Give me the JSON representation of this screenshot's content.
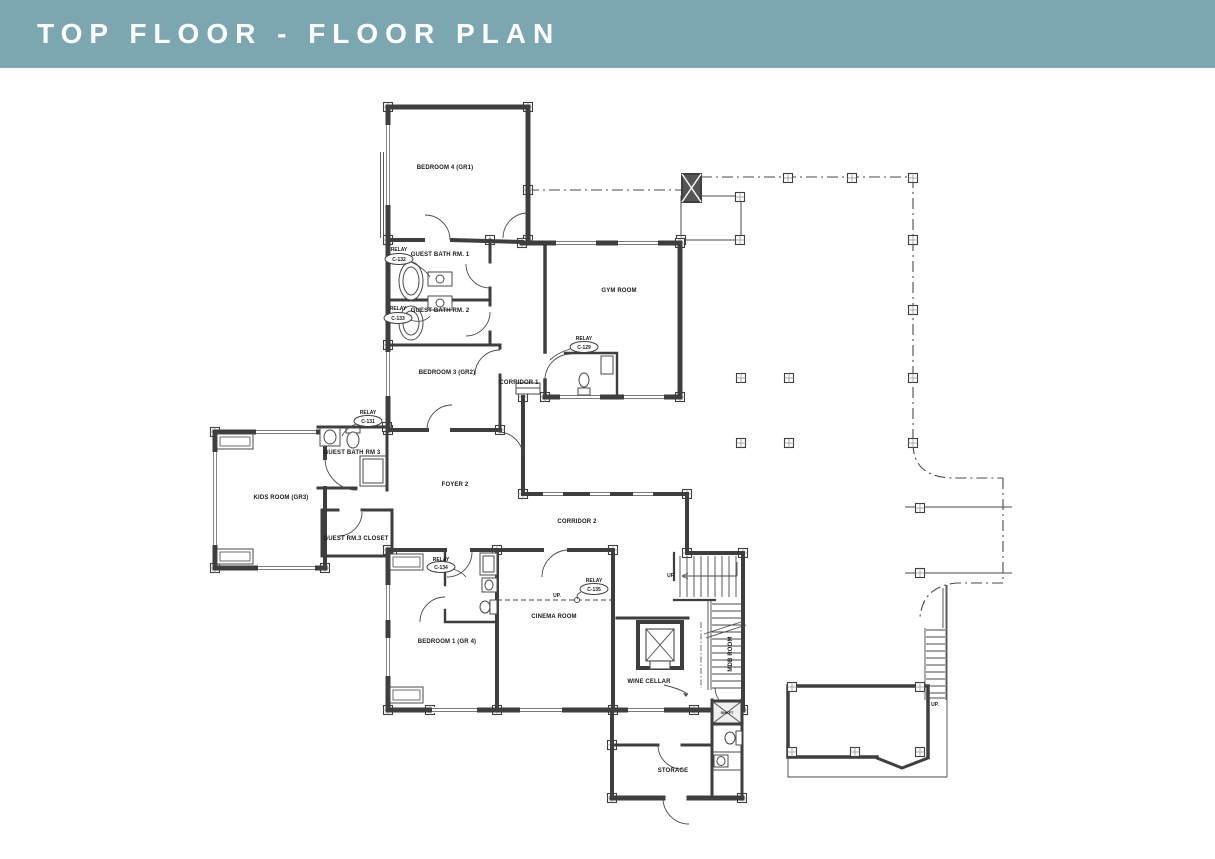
{
  "header": {
    "title": "TOP FLOOR - FLOOR PLAN"
  },
  "colors": {
    "header_bg": "#7BA7B1",
    "wall_line": "#3E3E3E",
    "label_text": "#1A1A1A",
    "paper": "#FFFFFF"
  },
  "plan": {
    "rooms": [
      {
        "label": "BEDROOM 4 (GR1)"
      },
      {
        "label": "GUEST BATH RM. 1"
      },
      {
        "label": "GUEST BATH RM. 2"
      },
      {
        "label": "BEDROOM 3 (GR2)"
      },
      {
        "label": "CORRIDOR 1"
      },
      {
        "label": "GYM ROOM"
      },
      {
        "label": "GUEST BATH RM 3"
      },
      {
        "label": "KIDS ROOM (GR3)"
      },
      {
        "label": "FOYER 2"
      },
      {
        "label": "CORRIDOR 2"
      },
      {
        "label": "GUEST RM.3 CLOSET"
      },
      {
        "label": "BEDROOM 1 (GR 4)"
      },
      {
        "label": "CINEMA ROOM"
      },
      {
        "label": "WINE CELLAR"
      },
      {
        "label": "MDB ROOM"
      },
      {
        "label": "STORAGE"
      },
      {
        "label": "SHAFT"
      }
    ],
    "relays": [
      {
        "label": "RELAY",
        "code": "C-132"
      },
      {
        "label": "RELAY",
        "code": "C-133"
      },
      {
        "label": "RELAY",
        "code": "C-129"
      },
      {
        "label": "RELAY",
        "code": "C-131"
      },
      {
        "label": "RELAY",
        "code": "C-134"
      },
      {
        "label": "RELAY",
        "code": "C-135"
      }
    ],
    "direction_labels": [
      {
        "label": "UP."
      },
      {
        "label": "UP."
      },
      {
        "label": "UP."
      }
    ]
  }
}
